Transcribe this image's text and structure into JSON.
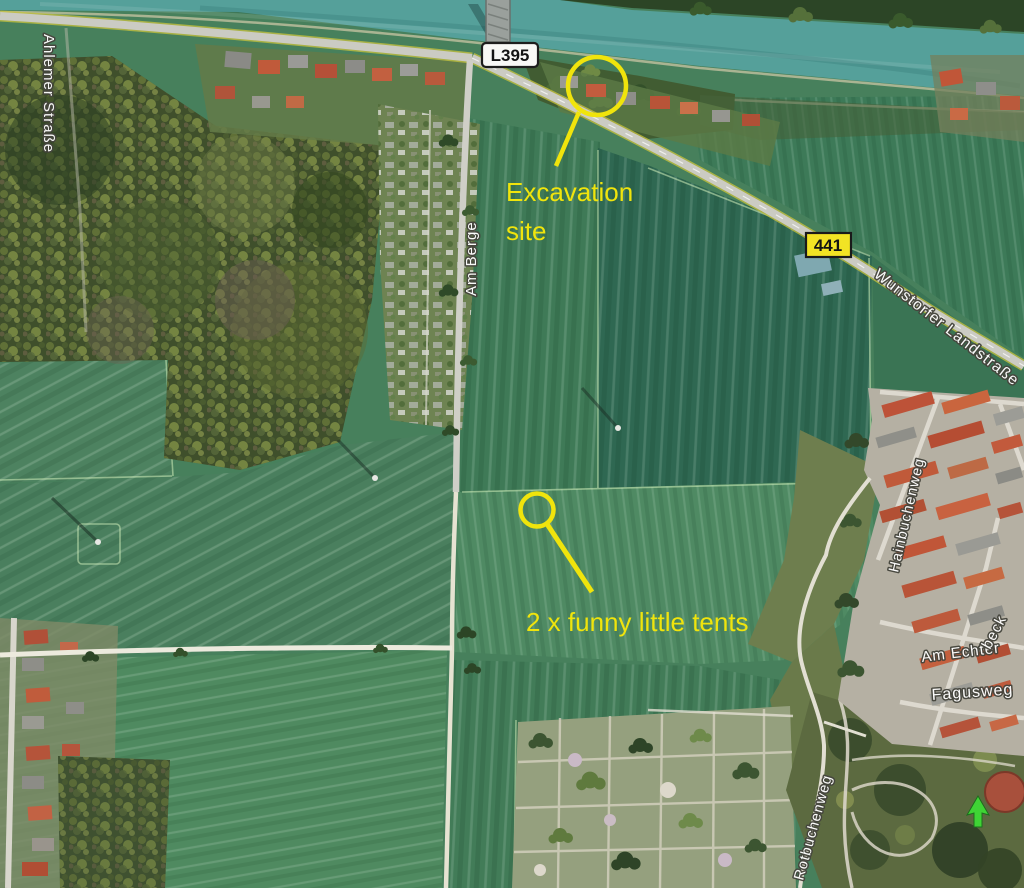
{
  "map": {
    "source_type": "satellite-aerial-view",
    "water_color": "#55a09a",
    "field_color": "#47805c",
    "forest_color": "#3f4f2b",
    "annotation_color": "#f0e40c"
  },
  "annotations": {
    "excavation": {
      "line1": "Excavation",
      "line2": "site"
    },
    "tents": {
      "label": "2 x funny little tents"
    }
  },
  "road_badges": {
    "l395": "L395",
    "b441": "441"
  },
  "street_labels": {
    "ahlemer": "Ahlemer Straße",
    "am_berge": "Am Berge",
    "wunstorfer": "Wunstorfer Landstraße",
    "hainbuchenweg": "Hainbuchenweg",
    "echterbeck_a": "Am Echter",
    "echterbeck_b": "beck",
    "fagusweg": "Fagusweg",
    "rotbuchenweg": "Rotbuchenweg"
  },
  "markers": {
    "tree_arrow_icon": "green-arrow-marker",
    "tree_arrow_color": "#3fd435"
  }
}
